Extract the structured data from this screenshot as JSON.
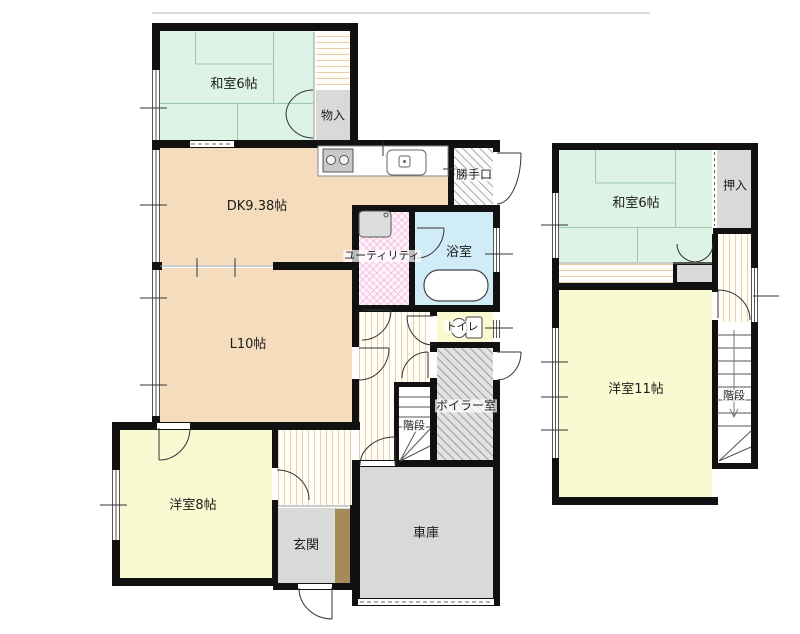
{
  "title": "house-floor-plan",
  "floors": [
    {
      "id": "1f",
      "rooms": [
        {
          "id": "washitsu-1f",
          "label": "和室6帖"
        },
        {
          "id": "monoire",
          "label": "物入"
        },
        {
          "id": "dining-kitchen",
          "label": "DK9.38帖"
        },
        {
          "id": "katteguchi",
          "label": "勝手口"
        },
        {
          "id": "utility",
          "label": "ユーティリティ"
        },
        {
          "id": "bathroom",
          "label": "浴室"
        },
        {
          "id": "living",
          "label": "L10帖"
        },
        {
          "id": "toilet",
          "label": "トイレ"
        },
        {
          "id": "boiler-room",
          "label": "ボイラー室"
        },
        {
          "id": "stairs-1f",
          "label": "階段"
        },
        {
          "id": "yoshitsu-8",
          "label": "洋室8帖"
        },
        {
          "id": "genkan",
          "label": "玄関"
        },
        {
          "id": "garage",
          "label": "車庫"
        }
      ]
    },
    {
      "id": "2f",
      "rooms": [
        {
          "id": "washitsu-2f",
          "label": "和室6帖"
        },
        {
          "id": "oshiire",
          "label": "押入"
        },
        {
          "id": "yoshitsu-11",
          "label": "洋室11帖"
        },
        {
          "id": "stairs-2f",
          "label": "階段"
        }
      ]
    }
  ],
  "fixtures": [
    {
      "name": "gas-stove-icon"
    },
    {
      "name": "kitchen-sink-icon"
    },
    {
      "name": "washing-machine-icon"
    },
    {
      "name": "bathtub-icon"
    },
    {
      "name": "toilet-icon"
    }
  ],
  "colors": {
    "wall": "#111111",
    "tatami": "#ddf3e6",
    "tatami_line": "#9cc7b1",
    "dining_kitchen_tan": "#f4dcbc",
    "western_room_yellow": "#fafad2",
    "bath_blue": "#d0ecf7",
    "utility_pink_base": "#fdf2f9",
    "storage_gray": "#d9d9d9",
    "entrance_step_brown": "#a78a59",
    "hall_stripe_tan": "#eccfa7",
    "hatch_white_base": "#fbfbfb",
    "boiler_gray_base": "#e2e2e2",
    "stairs_white": "#ffffff"
  }
}
